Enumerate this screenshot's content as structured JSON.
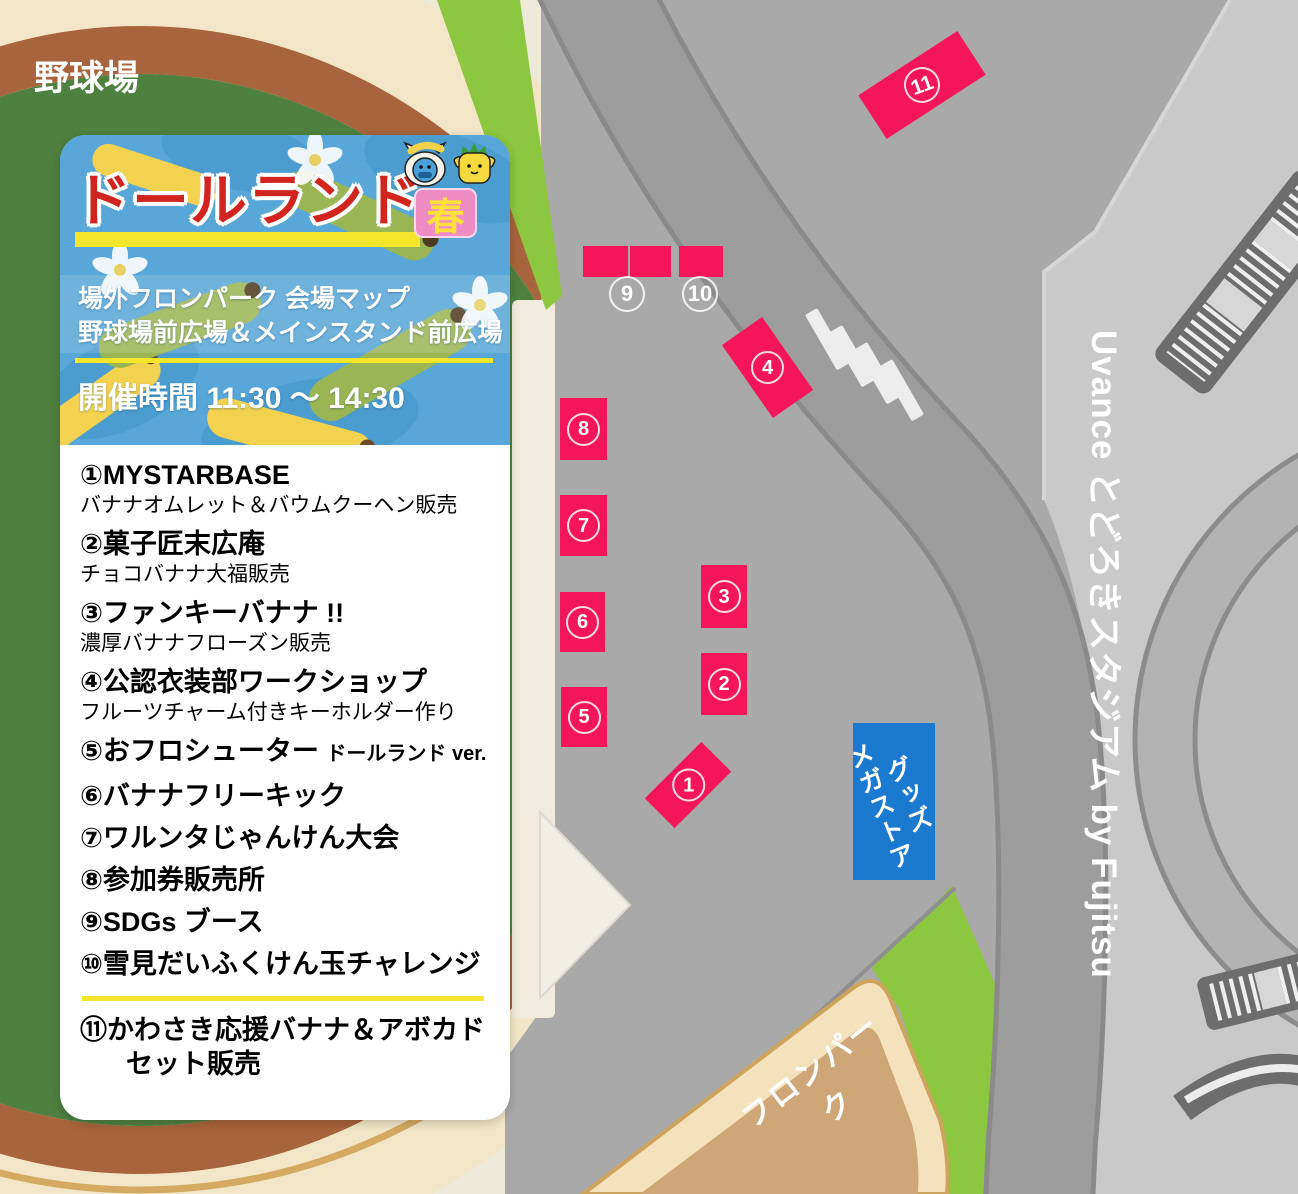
{
  "colors": {
    "booth_pink": "#f4155a",
    "store_blue": "#1b79cf",
    "title_red": "#d2241f",
    "accent_yellow": "#f5e52b",
    "badge_pink": "#f08cc4",
    "badge_text_yellow": "#ffe13a",
    "grass_green": "#8dc63f",
    "field_green": "#4e8140",
    "dirt_brown": "#a8643c",
    "sand_cream": "#f3e6c8",
    "fronpark_tan": "#cfa678",
    "road_gray": "#9d9d9d",
    "plaza_gray": "#a9a9a9",
    "stadium_gray": "#c9c9c9"
  },
  "labels": {
    "baseball_field": "野球場",
    "fronpark": "フロンパーク",
    "stadium_vertical": "Uvance とどろきスタジアム by Fujitsu",
    "goods_store_line1": "グッズ",
    "goods_store_line2": "メガストア"
  },
  "card": {
    "title": "ドールランド",
    "season_badge": "春",
    "subtitle_line1": "場外フロンパーク 会場マップ",
    "subtitle_line2": "野球場前広場＆メインスタンド前広場",
    "time_label": "開催時間 11:30 ～ 14:30",
    "items": [
      {
        "title": "①MYSTARBASE",
        "desc": "バナナオムレット＆バウムクーヘン販売"
      },
      {
        "title": "②菓子匠末広庵",
        "desc": "チョコバナナ大福販売"
      },
      {
        "title": "③ファンキーバナナ !!",
        "desc": "濃厚バナナフローズン販売"
      },
      {
        "title": "④公認衣装部ワークショップ",
        "desc": "フルーツチャーム付きキーホルダー作り"
      },
      {
        "title": "⑤おフロシューター",
        "suffix": "ドールランド ver."
      },
      {
        "title": "⑥バナナフリーキック"
      },
      {
        "title": "⑦ワルンタじゃんけん大会"
      },
      {
        "title": "⑧参加券販売所"
      },
      {
        "title": "⑨SDGs ブース"
      },
      {
        "title": "⑩雪見だいふくけん玉チャレンジ"
      }
    ],
    "extra_item": {
      "line1": "⑪かわさき応援バナナ＆アボカド",
      "line2": "セット販売"
    }
  },
  "map_numbers": {
    "n1": "1",
    "n2": "2",
    "n3": "3",
    "n4": "4",
    "n5": "5",
    "n6": "6",
    "n7": "7",
    "n8": "8",
    "n9": "9",
    "n10": "10",
    "n11": "11"
  }
}
